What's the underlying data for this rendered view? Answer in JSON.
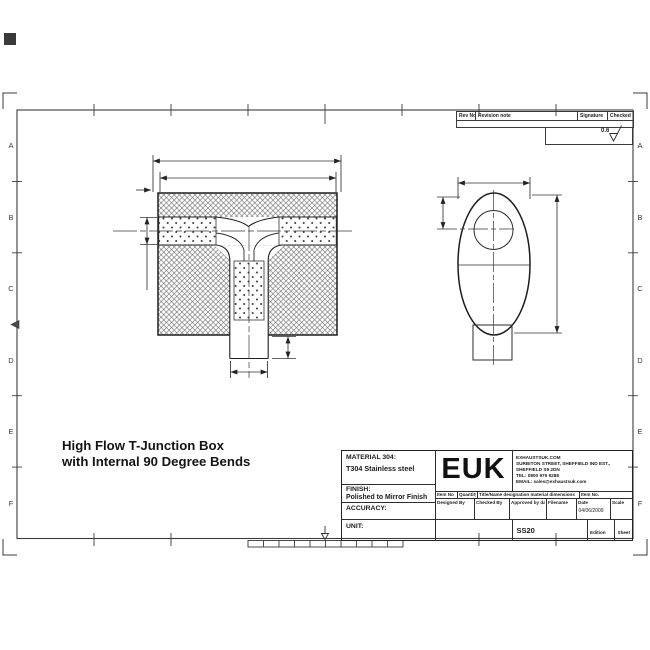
{
  "sheet": {
    "zone_letters": [
      "A",
      "B",
      "C",
      "D",
      "E",
      "F"
    ],
    "roughness_value": "0.6",
    "line_color": "#2a2a2a"
  },
  "revision_table": {
    "headers": [
      "Rev No",
      "Revision note",
      "Signature",
      "Checked"
    ]
  },
  "drawing_title": {
    "line1": "High Flow T-Junction Box",
    "line2": "with Internal 90 Degree Bends"
  },
  "title_block": {
    "material_label": "MATERIAL 304:",
    "material_value": "T304 Stainless steel",
    "finish_label": "FINISH:",
    "finish_value": "Polished to Mirror Finish",
    "accuracy_label": "ACCURACY:",
    "unit_label": "UNIT:",
    "logo": "EUK",
    "company": {
      "website": "EXHAUSTSUK.COM",
      "address1": "SURBITON STREET, SHEFFIELD IND EST.,",
      "address2": "SHEFFIELD S9 2DN",
      "tel": "TEL: 0800 975 9288",
      "email": "EMAIL: sales@exhaustsuk.com"
    },
    "row1_headers": [
      "Item No",
      "Quantity",
      "Title/Name designation material dimensions",
      "Item No."
    ],
    "row2_headers": [
      "Designed By",
      "Checked By",
      "Approved by date",
      "Filename",
      "Date",
      "Scale"
    ],
    "date_value": "04/06/2009",
    "drawing_number": "SS20",
    "edition_label": "Edition",
    "sheet_label": "Sheet"
  }
}
